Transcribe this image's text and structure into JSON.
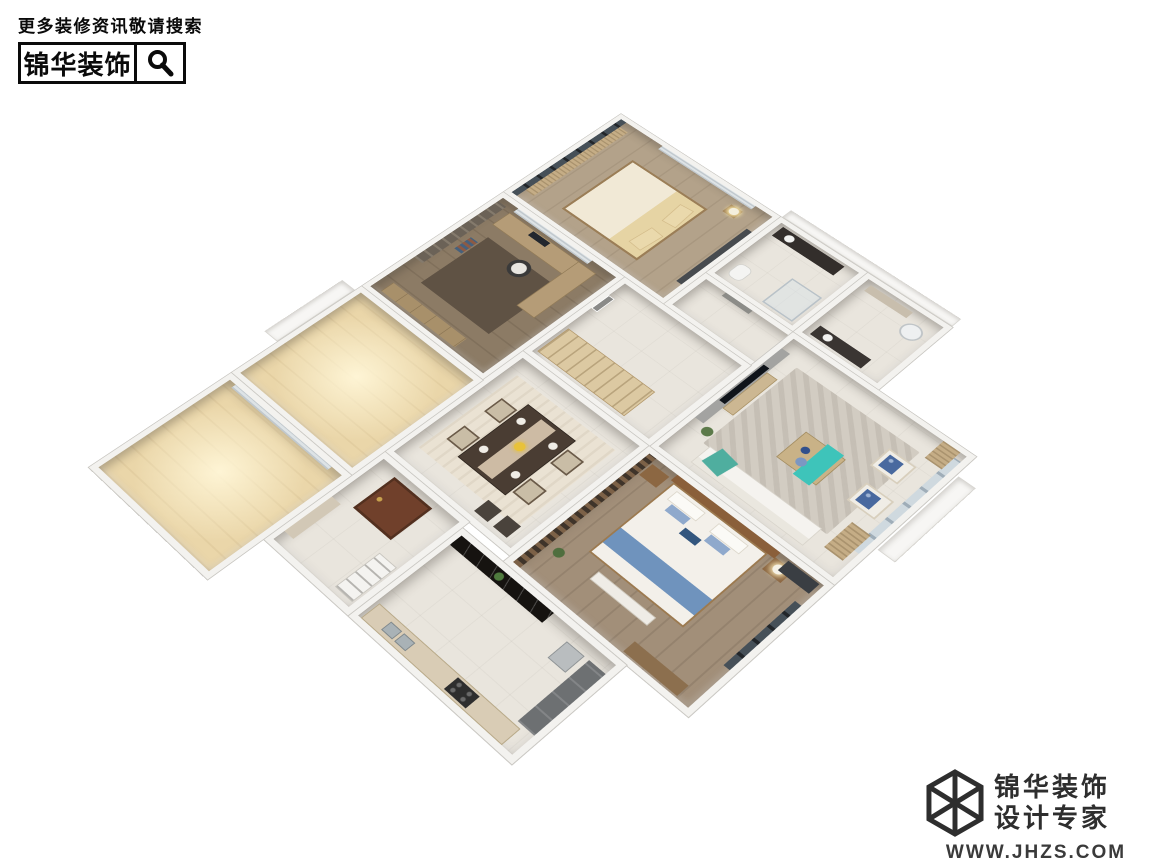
{
  "branding_header": {
    "tagline": "更多装修资讯敬请搜索",
    "brand_name": "锦华装饰"
  },
  "branding_footer": {
    "brand_name": "锦华装饰",
    "brand_subtitle": "设计专家",
    "website": "WWW.JHZS.COM"
  },
  "colors": {
    "brand_black": "#0a0a0a",
    "footer_gray": "#2e2e2e",
    "background": "#ffffff",
    "wall_white": "#f3f2ef",
    "wood_floor_warm": "#b3a28a",
    "wood_floor_dark": "#8c7b65",
    "balcony_wood": "#ead6a9",
    "teal_accent": "#3ec4ba",
    "blue_accent": "#6f93bd",
    "bar_counter_black": "#161310",
    "entry_door_brown": "#70402b"
  },
  "floorplan": {
    "description": "isometric 3D apartment floor plan render",
    "rooms": [
      {
        "id": "master-bedroom"
      },
      {
        "id": "master-bathroom"
      },
      {
        "id": "bathroom"
      },
      {
        "id": "corridor"
      },
      {
        "id": "living-room"
      },
      {
        "id": "study"
      },
      {
        "id": "hallway"
      },
      {
        "id": "dining-room"
      },
      {
        "id": "second-bedroom"
      },
      {
        "id": "kitchen"
      },
      {
        "id": "entry"
      },
      {
        "id": "balcony-a"
      },
      {
        "id": "balcony-b"
      }
    ]
  }
}
